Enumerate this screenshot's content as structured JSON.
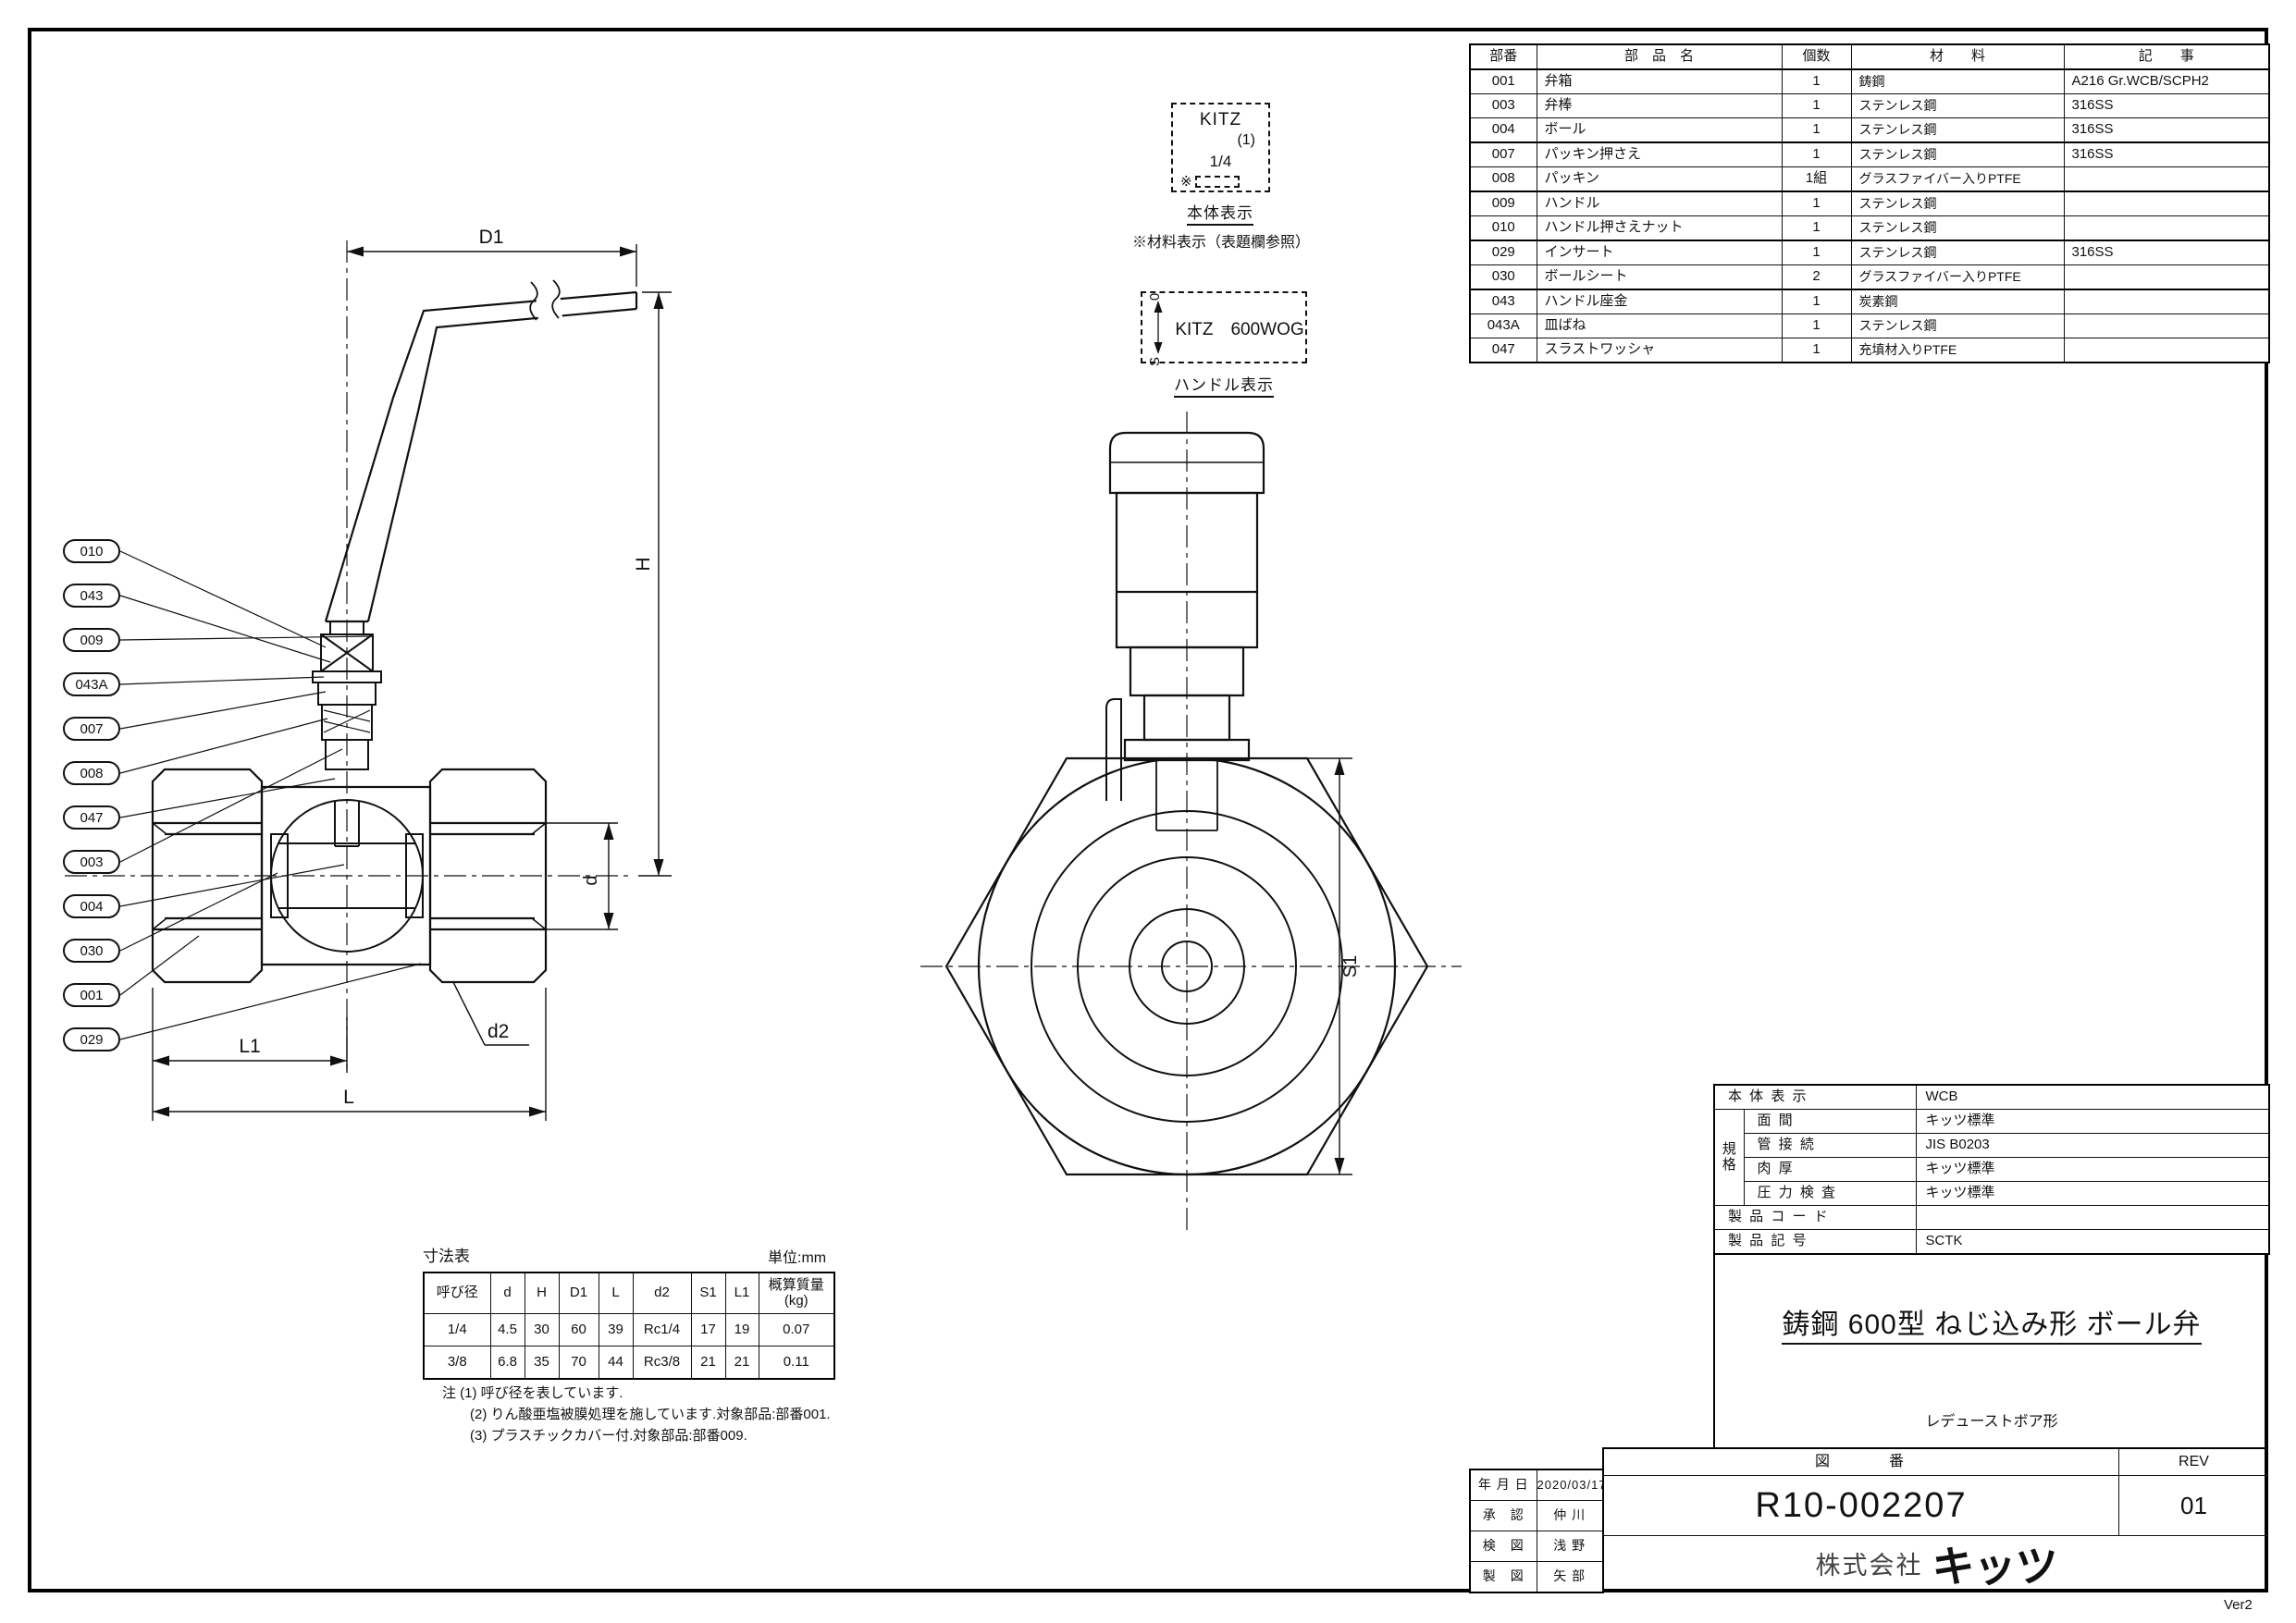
{
  "sheet": {
    "version": "Ver2"
  },
  "callouts": [
    "010",
    "043",
    "009",
    "043A",
    "007",
    "008",
    "047",
    "003",
    "004",
    "030",
    "001",
    "029"
  ],
  "dimension_labels": {
    "d1": "D1",
    "h": "H",
    "d": "d",
    "s1": "S1",
    "l1": "L1",
    "l": "L",
    "d2": "d2"
  },
  "annotations": {
    "body_marking": {
      "line1": "KITZ",
      "line2": "(1)",
      "line3": "1/4",
      "line4_prefix": "※",
      "label": "本体表示",
      "note": "※材料表示（表題欄参照）"
    },
    "handle_marking": {
      "text": "KITZ　600WOG",
      "open_mark": "0",
      "shut_mark": "S",
      "label": "ハンドル表示"
    }
  },
  "parts_table": {
    "headers": {
      "no": "部番",
      "name": "部　品　名",
      "qty": "個数",
      "material": "材　　料",
      "remarks": "記　　事"
    },
    "rows": [
      {
        "no": "001",
        "name": "弁箱",
        "qty": "1",
        "material": "鋳鋼",
        "remarks": "A216 Gr.WCB/SCPH2"
      },
      {
        "no": "003",
        "name": "弁棒",
        "qty": "1",
        "material": "ステンレス鋼",
        "remarks": "316SS"
      },
      {
        "no": "004",
        "name": "ボール",
        "qty": "1",
        "material": "ステンレス鋼",
        "remarks": "316SS"
      },
      {
        "no": "007",
        "name": "パッキン押さえ",
        "qty": "1",
        "material": "ステンレス鋼",
        "remarks": "316SS"
      },
      {
        "no": "008",
        "name": "パッキン",
        "qty": "1組",
        "material": "グラスファイバー入りPTFE",
        "remarks": ""
      },
      {
        "no": "009",
        "name": "ハンドル",
        "qty": "1",
        "material": "ステンレス鋼",
        "remarks": ""
      },
      {
        "no": "010",
        "name": "ハンドル押さえナット",
        "qty": "1",
        "material": "ステンレス鋼",
        "remarks": ""
      },
      {
        "no": "029",
        "name": "インサート",
        "qty": "1",
        "material": "ステンレス鋼",
        "remarks": "316SS"
      },
      {
        "no": "030",
        "name": "ボールシート",
        "qty": "2",
        "material": "グラスファイバー入りPTFE",
        "remarks": ""
      },
      {
        "no": "043",
        "name": "ハンドル座金",
        "qty": "1",
        "material": "炭素鋼",
        "remarks": ""
      },
      {
        "no": "043A",
        "name": "皿ばね",
        "qty": "1",
        "material": "ステンレス鋼",
        "remarks": ""
      },
      {
        "no": "047",
        "name": "スラストワッシャ",
        "qty": "1",
        "material": "充填材入りPTFE",
        "remarks": ""
      }
    ]
  },
  "dim_table": {
    "title": "寸法表",
    "unit": "単位:mm",
    "headers": [
      "呼び径",
      "d",
      "H",
      "D1",
      "L",
      "d2",
      "S1",
      "L1"
    ],
    "mass_header_l1": "概算質量",
    "mass_header_l2": "(kg)",
    "rows": [
      [
        "1/4",
        "4.5",
        "30",
        "60",
        "39",
        "Rc1/4",
        "17",
        "19",
        "0.07"
      ],
      [
        "3/8",
        "6.8",
        "35",
        "70",
        "44",
        "Rc3/8",
        "21",
        "21",
        "0.11"
      ]
    ],
    "notes": [
      "注 (1) 呼び径を表しています.",
      "(2) りん酸亜塩被膜処理を施しています.対象部品:部番001.",
      "(3) プラスチックカバー付.対象部品:部番009."
    ]
  },
  "title_block": {
    "spec": {
      "group_char_1": "規",
      "group_char_2": "格",
      "rows": [
        {
          "label": "本 体 表 示",
          "value": "WCB"
        },
        {
          "label": "面 間",
          "value": "キッツ標準"
        },
        {
          "label": "管 接 続",
          "value": "JIS B0203"
        },
        {
          "label": "肉 厚",
          "value": "キッツ標準"
        },
        {
          "label": "圧 力 検 査",
          "value": "キッツ標準"
        },
        {
          "label": "製 品 コ ー ド",
          "value": ""
        },
        {
          "label": "製 品 記 号",
          "value": "SCTK"
        }
      ]
    },
    "title": "鋳鋼 600型 ねじ込み形 ボール弁",
    "subtitle": "レデューストボア形",
    "zuban_label": "図　　　番",
    "rev_label": "REV",
    "drawing_number": "R10-002207",
    "rev": "01",
    "company_prefix": "株式会社",
    "company_name": "キッツ"
  },
  "approval_table": {
    "rows": [
      {
        "label": "年 月 日",
        "value": "2020/03/17"
      },
      {
        "label": "承　認",
        "value": "仲 川"
      },
      {
        "label": "検　図",
        "value": "浅 野"
      },
      {
        "label": "製　図",
        "value": "矢 部"
      }
    ]
  },
  "colors": {
    "ink": "#111111",
    "paper": "#ffffff"
  }
}
